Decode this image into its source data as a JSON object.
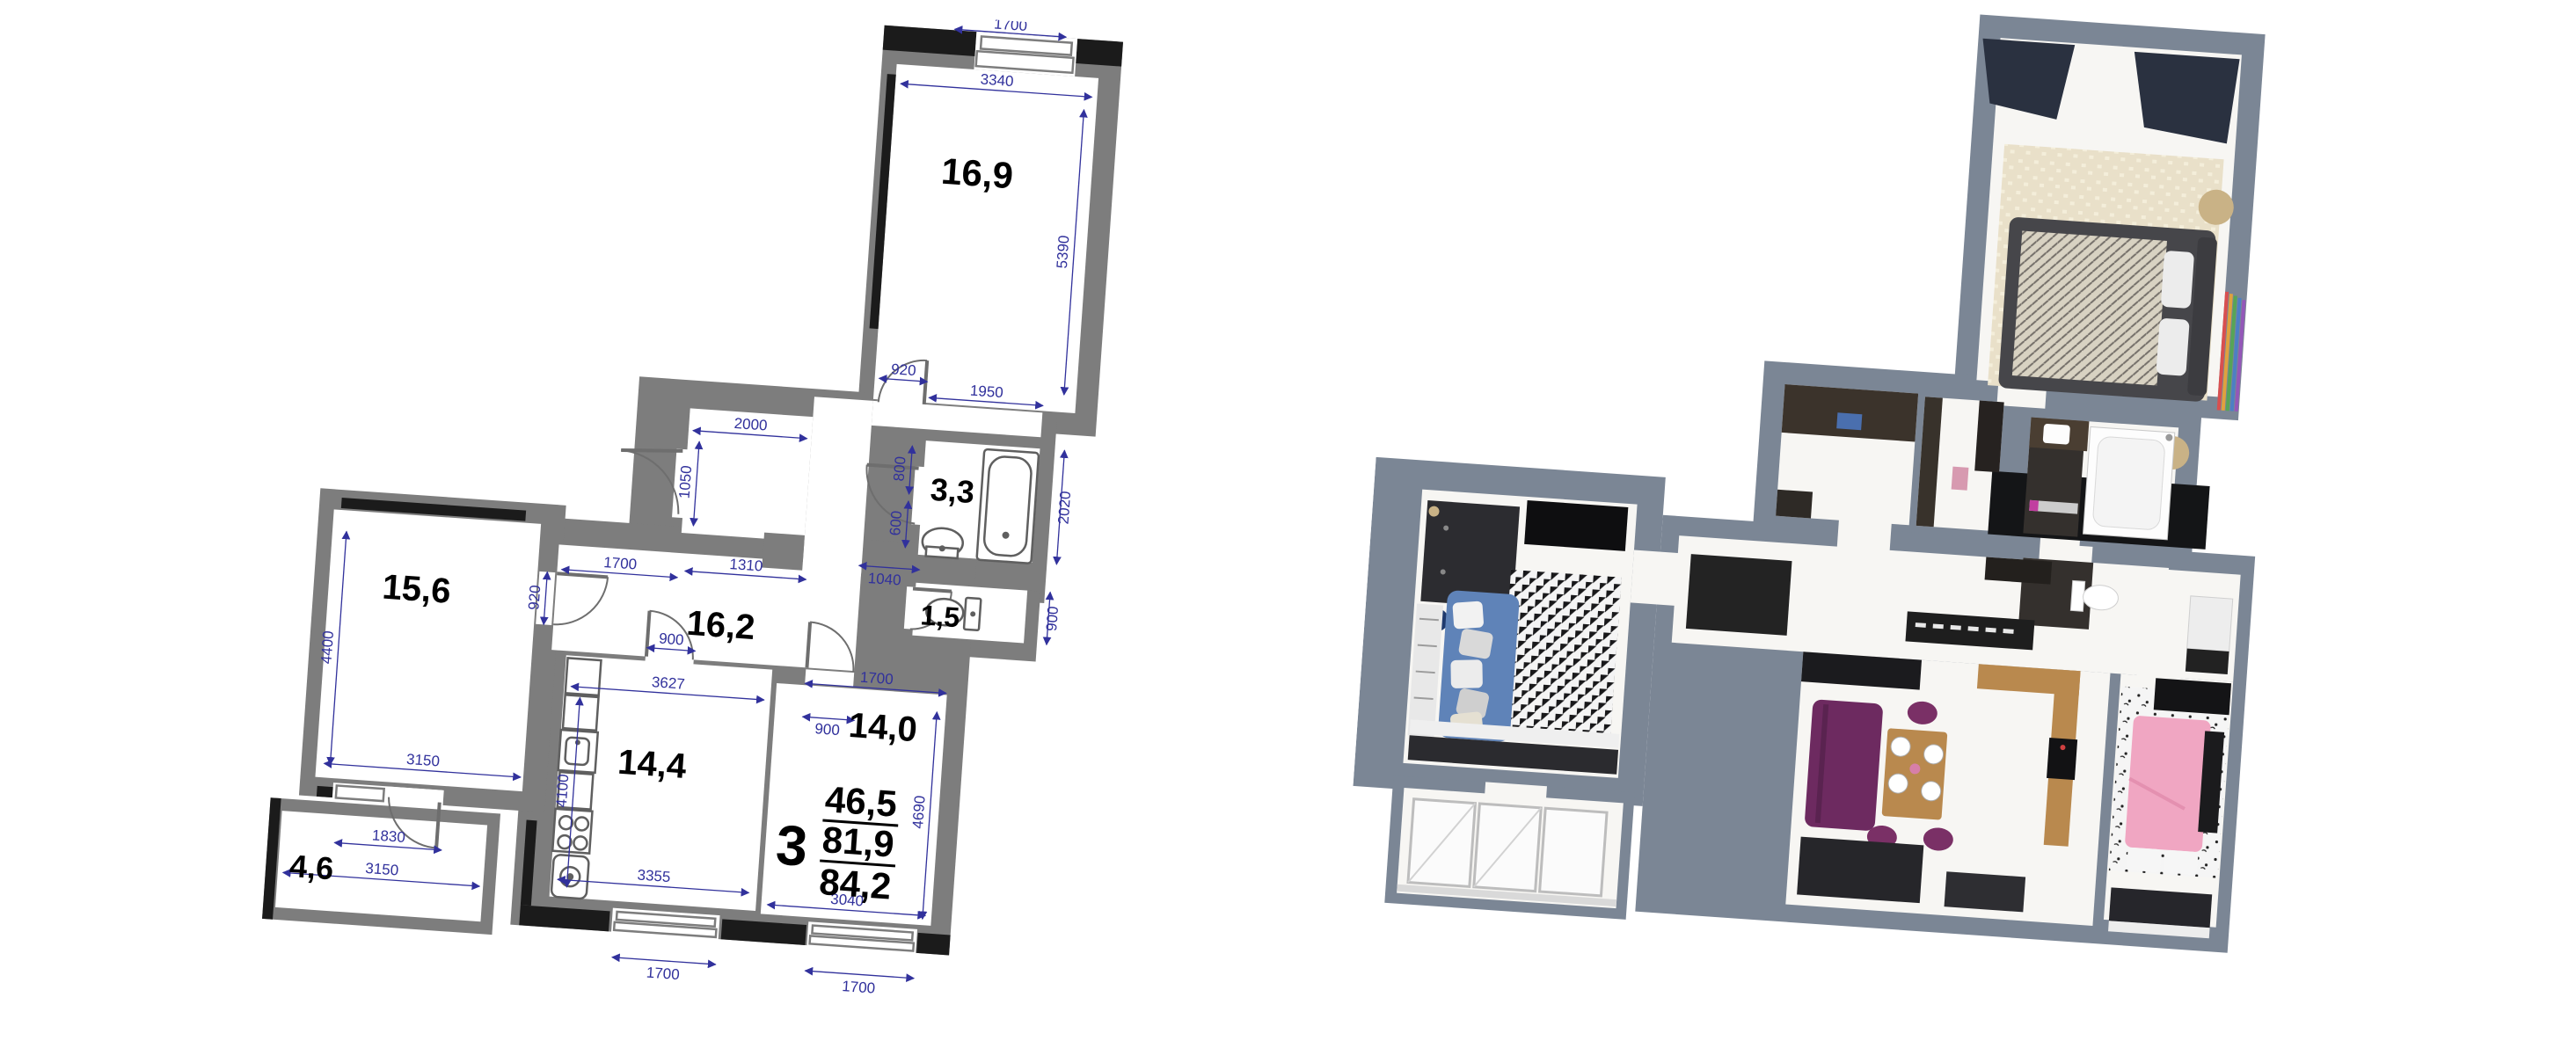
{
  "colors": {
    "plan_wall": "#7d7d7d",
    "plan_black": "#1b1b1b",
    "dimension_blue": "#31319c",
    "label_black": "#000000",
    "wall_3d": "#7b8695",
    "floor_3d": "#f7f6f3",
    "sofa_blue": "#5f83b8",
    "sofa_purple": "#6d2a60",
    "wood": "#b9894e",
    "bed_pink": "#f0a6c2",
    "rug_beige": "#e9e0c9"
  },
  "plan": {
    "rooms": [
      {
        "id": "bedroom",
        "area": "16,9"
      },
      {
        "id": "bathroom",
        "area": "3,3"
      },
      {
        "id": "wc",
        "area": "1,5"
      },
      {
        "id": "hallway",
        "area": "16,2"
      },
      {
        "id": "living-room",
        "area": "15,6"
      },
      {
        "id": "kitchen",
        "area": "14,4"
      },
      {
        "id": "bedroom-2",
        "area": "14,0"
      },
      {
        "id": "balcony",
        "area": "4,6"
      }
    ],
    "summary": {
      "rooms_count": "3",
      "living_area": "46,5",
      "heated_area": "81,9",
      "total_area": "84,2"
    },
    "dims": {
      "win_top": "1700",
      "bed_w": "3340",
      "bed_h": "5390",
      "bed_door": "920",
      "bath_w": "1950",
      "hall_top_w": "2000",
      "hall_top_h": "1050",
      "bath_door": "800",
      "bath_side": "600",
      "bath_h": "2020",
      "wc_w": "1040",
      "wc_h": "900",
      "hall_left": "1700",
      "hall_mid": "1310",
      "bed2_top": "1700",
      "bed2_door": "900",
      "bed2_h": "4690",
      "bed2_w": "3040",
      "kitchen_door": "900",
      "kitchen_top": "3627",
      "kitchen_h": "4100",
      "kitchen_bottom": "3355",
      "living_h": "4400",
      "living_w": "3150",
      "living_door": "920",
      "balcony_door": "1830",
      "balcony_w": "3150",
      "win_kitchen": "1700",
      "win_bed2": "1700"
    },
    "icons": [
      "bathtub",
      "sink",
      "toilet",
      "stove",
      "kitchen-sink",
      "washing-machine",
      "door-arc",
      "window"
    ]
  },
  "render3d": {
    "rooms": [
      "bedroom",
      "entry-closet",
      "bathroom",
      "wc",
      "corridor",
      "living-room",
      "kitchen-dining",
      "bedroom-2",
      "balcony"
    ],
    "furniture": [
      "double-bed",
      "wardrobe",
      "curtains",
      "blue-sofa",
      "tv",
      "triangle-rug",
      "purple-sofa",
      "dining-table",
      "pink-bed",
      "bathtub",
      "toilet",
      "kitchen-counter"
    ]
  }
}
